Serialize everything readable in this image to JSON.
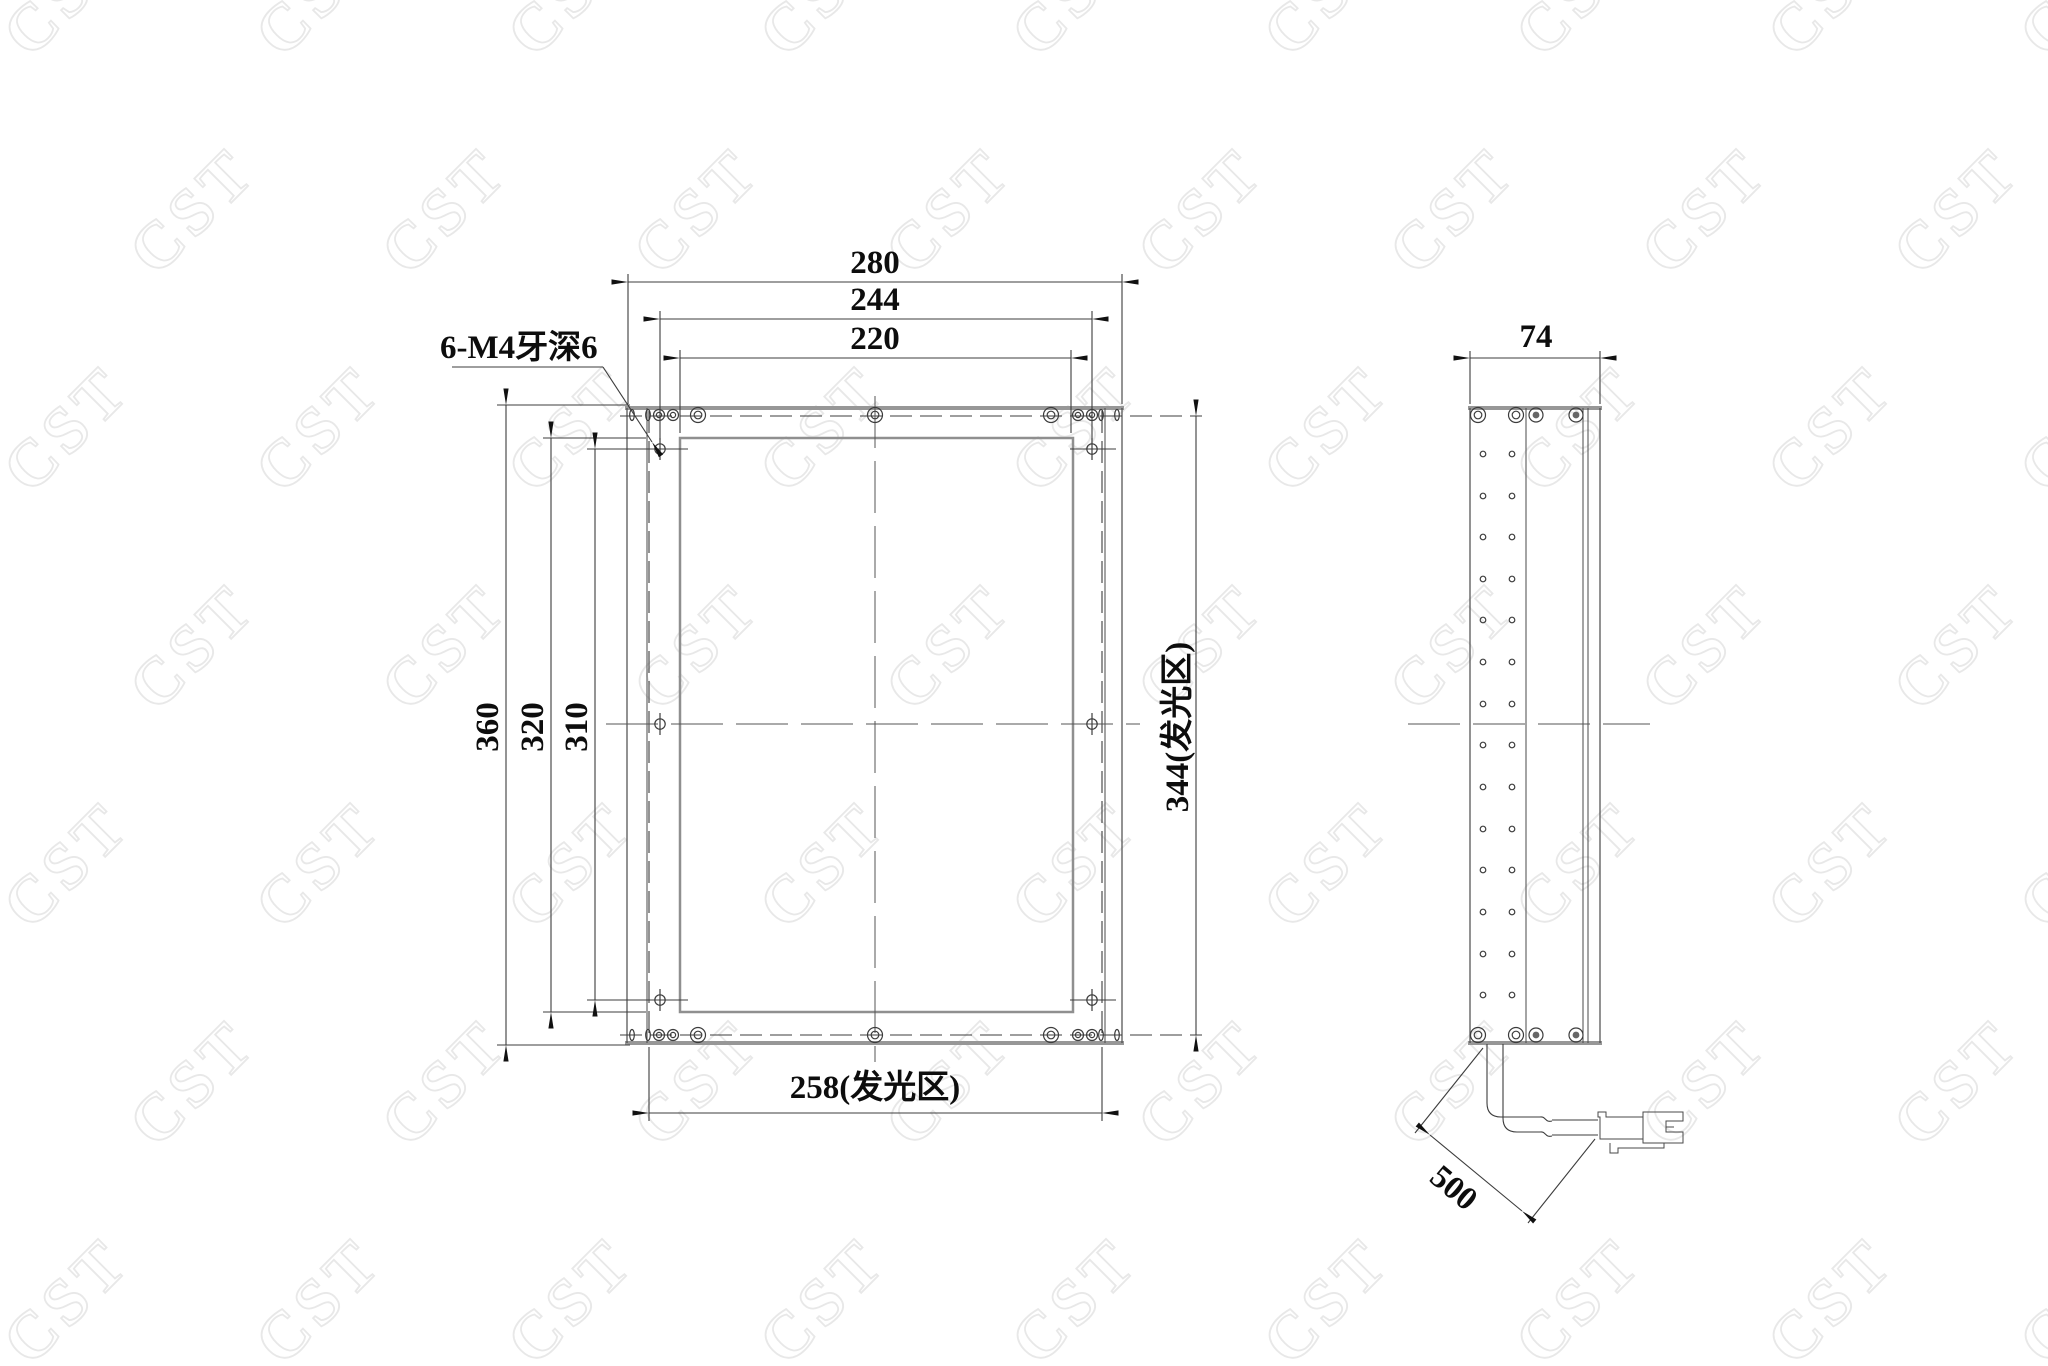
{
  "watermark": {
    "text": "CST"
  },
  "front_view": {
    "thread_note": "6-M4牙深6",
    "dims": {
      "outer_width": "280",
      "hole_span_width": "244",
      "inner_width": "220",
      "outer_height": "360",
      "inner_height": "320",
      "hole_span_height": "310",
      "luminous_height": "344(发光区)",
      "luminous_width": "258(发光区)"
    }
  },
  "side_view": {
    "dims": {
      "depth": "74",
      "cable_length": "500"
    }
  },
  "colors": {
    "background": "#ffffff",
    "line": "#3c3c3c",
    "thick_edge": "#979797",
    "watermark": "#e8e8e8"
  }
}
